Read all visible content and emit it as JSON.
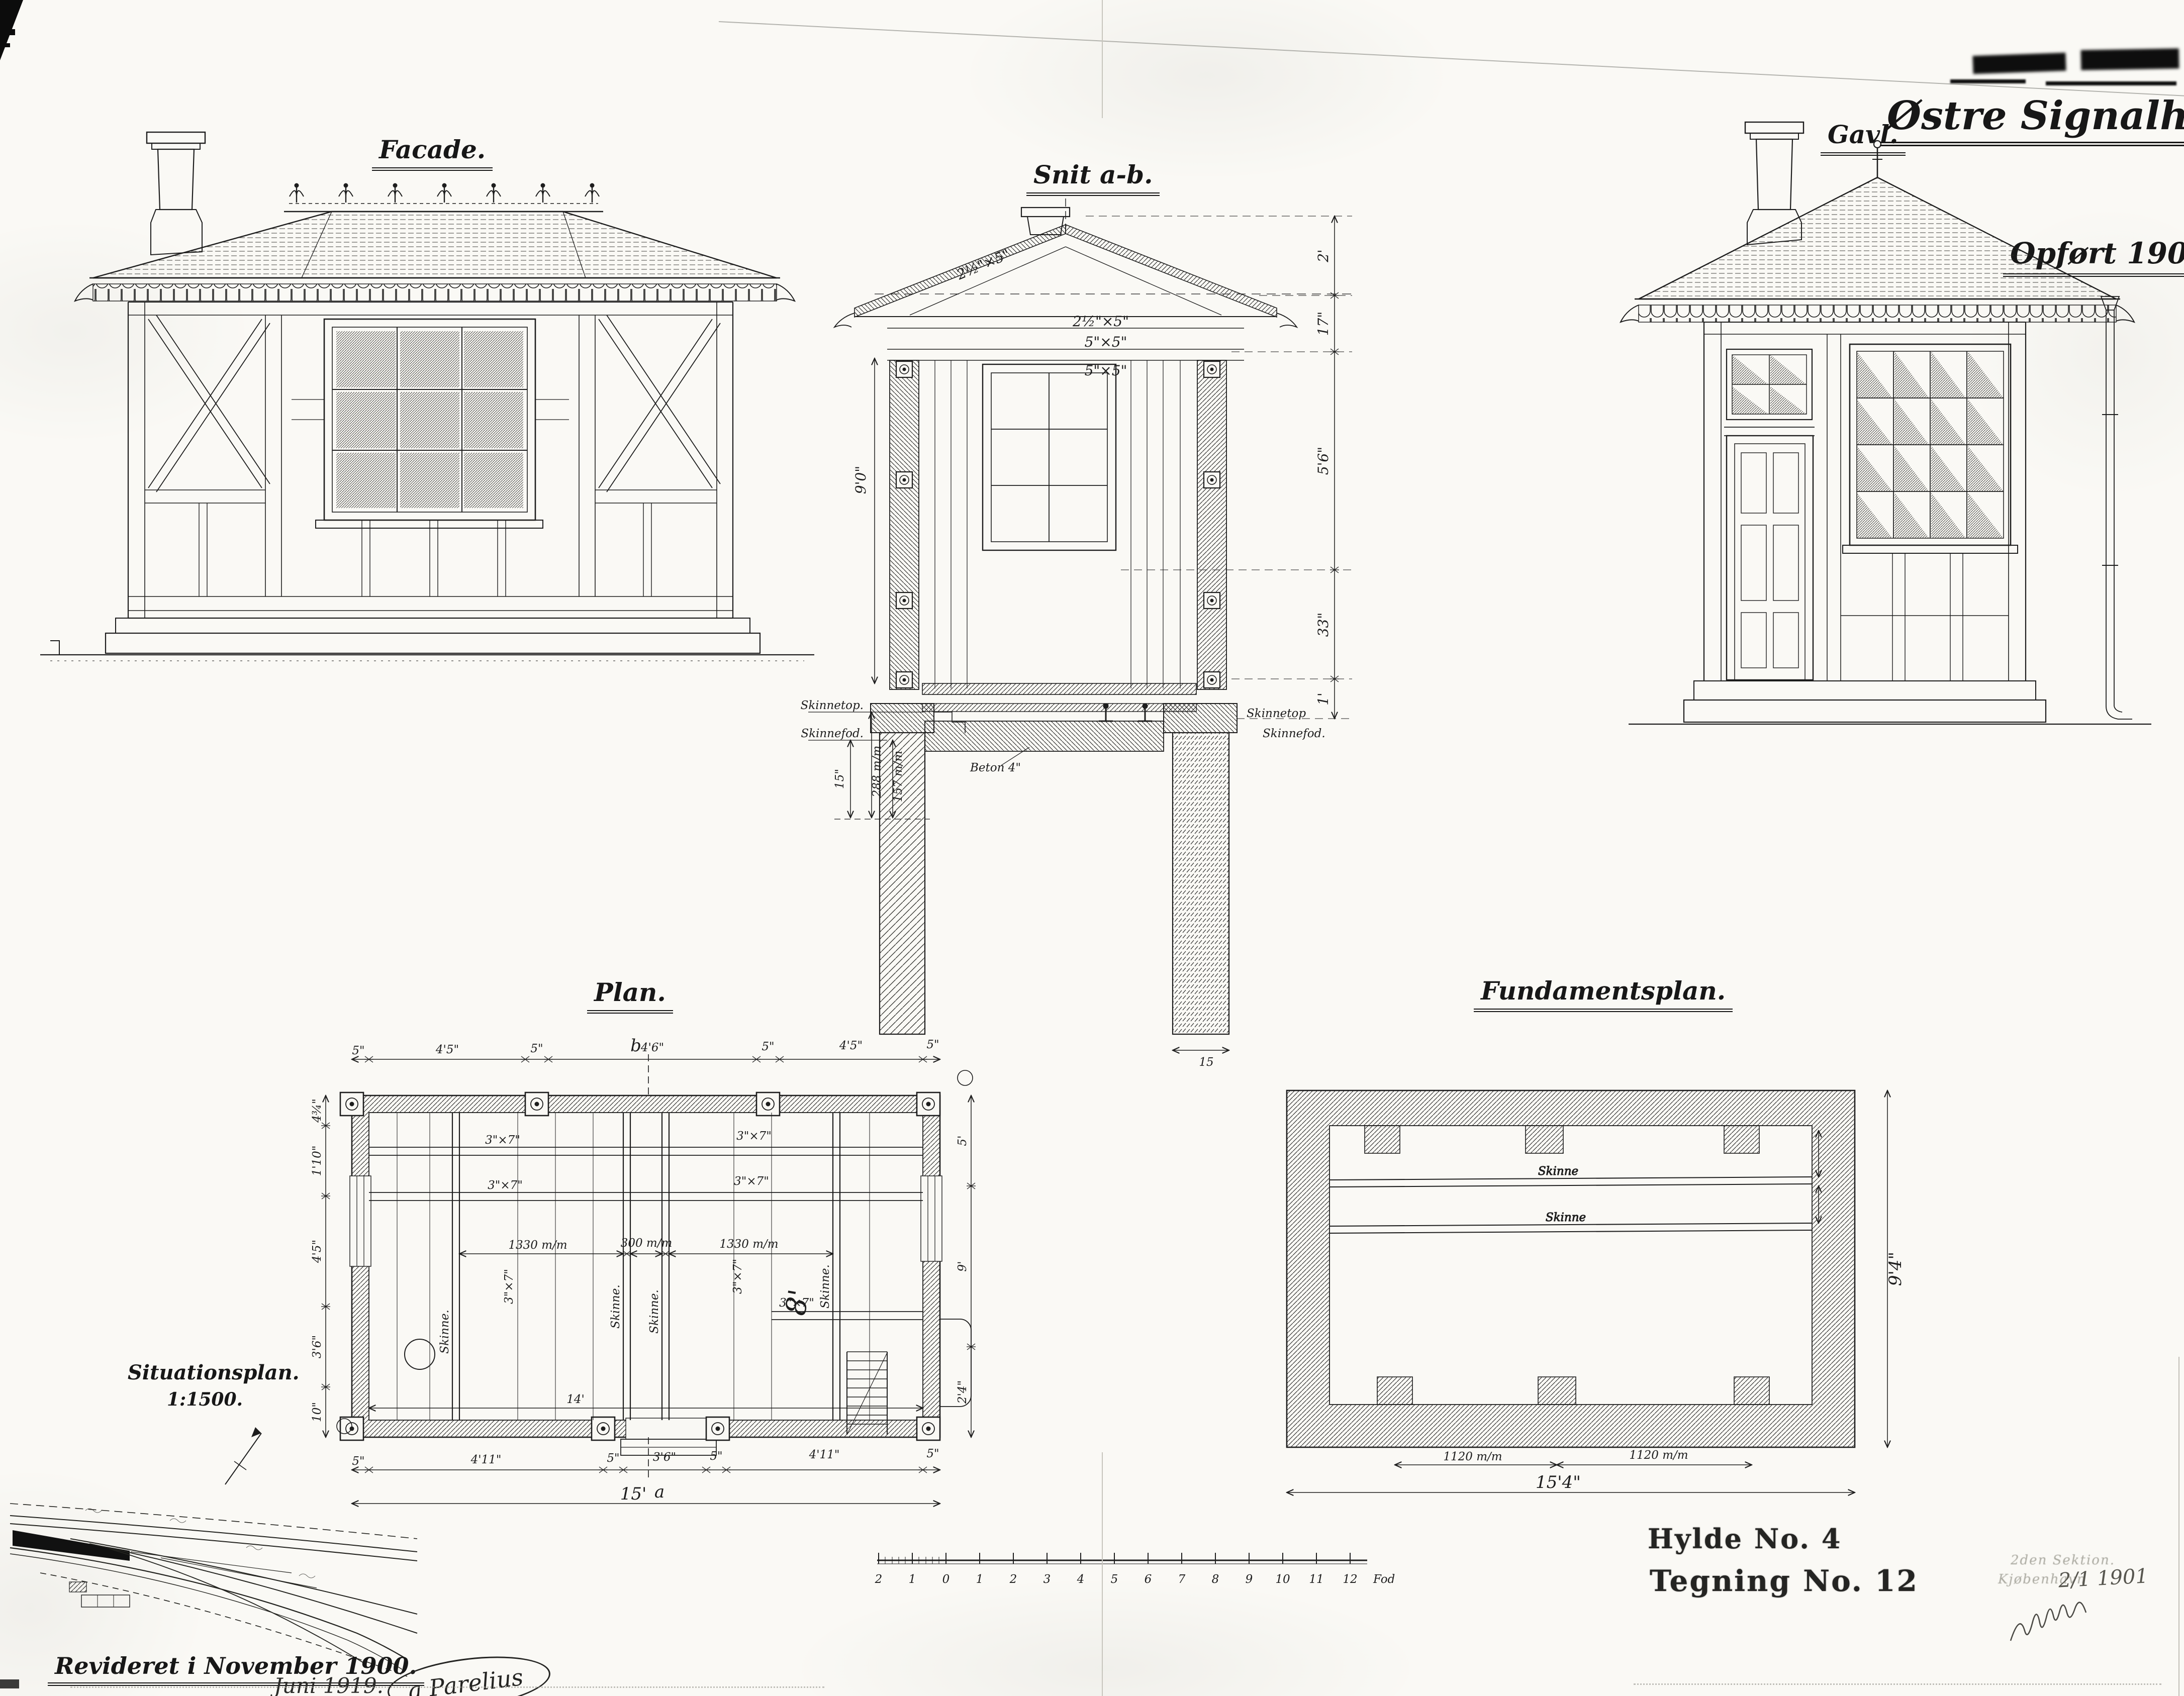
{
  "header": {
    "title": "Østre Signalhus.",
    "built_note": "Opført 1900."
  },
  "views": {
    "facade": {
      "title": "Facade."
    },
    "section": {
      "title": "Snit a-b.",
      "rafter_dim": "2½\"×5\"",
      "purlin_dim": "2½\"×5\"",
      "beam_dim_upper": "5\"×5\"",
      "beam_dim_lower": "5\"×5\"",
      "interior_height": "9'0\"",
      "right_dims": [
        "2'",
        "17\"",
        "5'6\"",
        "33\"",
        "1'"
      ],
      "rail_top_label": "Skinnetop.",
      "rail_foot_label": "Skinnefod.",
      "rail_top_label_right": "Skinnetop",
      "rail_foot_label_right": "Skinnefod.",
      "depth_dim": "15\"",
      "gauge_dim_a": "288 m/m",
      "gauge_dim_b": "157 m/m",
      "concrete_label": "Beton 4\"",
      "pier_width_dim": "15"
    },
    "gable": {
      "title": "Gavl."
    },
    "plan": {
      "title": "Plan.",
      "marker_top": "b",
      "marker_bottom": "a",
      "top_dims": [
        "5\"",
        "4'5\"",
        "5\"",
        "4'6\"",
        "5\"",
        "4'5\"",
        "5\""
      ],
      "bottom_dims": [
        "5\"",
        "4'11\"",
        "5\"",
        "3'6\"",
        "5\"",
        "4'11\"",
        "5\""
      ],
      "total_width": "15'",
      "clear_width": "14'",
      "left_dims": [
        "4¾\"",
        "1'10\"",
        "4'5\"",
        "3'6\"",
        "10\""
      ],
      "right_dims": [
        "5'",
        "9'",
        "2'4\""
      ],
      "gauge_dims": [
        "1330 m/m",
        "300 m/m",
        "1330 m/m"
      ],
      "beam_dim": "3\"×7\"",
      "rail_label": "Skinne.",
      "clear_depth": "8'"
    },
    "foundation": {
      "title": "Fundamentsplan.",
      "rail_label": "Skinne",
      "pier_spacing": "1120 m/m",
      "total_width": "15'4\"",
      "total_depth": "9'4\""
    },
    "situation": {
      "title": "Situationsplan.",
      "scale": "1:1500."
    }
  },
  "scale_bar": {
    "ticks": [
      "2",
      "1",
      "0",
      "1",
      "2",
      "3",
      "4",
      "5",
      "6",
      "7",
      "8",
      "9",
      "10",
      "11",
      "12"
    ],
    "unit": "Fod"
  },
  "footer": {
    "revised": "Revideret i November 1900.",
    "revised_dots": ". . . . . .",
    "revised2": "Juni 1919.",
    "signature": "a Parelius",
    "shelf_no": "Hylde No. 4",
    "drawing_no": "Tegning No. 12",
    "stamp_line1": "2den Sektion.",
    "stamp_line2": "Kjøbenhavn",
    "stamp_date": "2/1 1901"
  }
}
